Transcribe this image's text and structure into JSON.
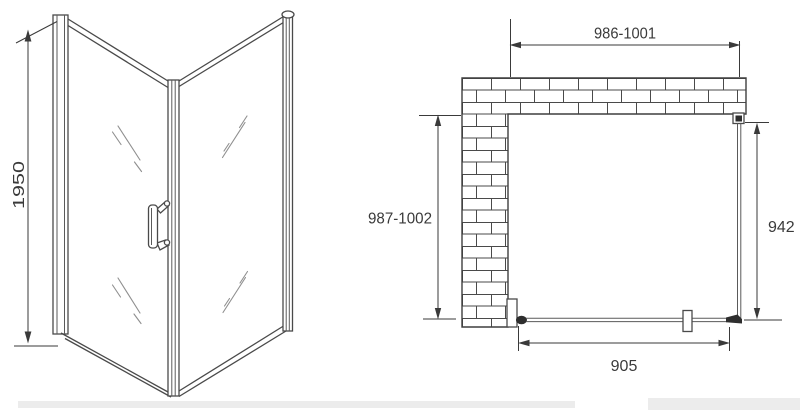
{
  "colors": {
    "background": "#ffffff",
    "line": "#4a4a4a",
    "dimension": "#3a3a3a",
    "dark_fill": "#2e2e2e",
    "glass_shine": "#8f8f8f",
    "brick": "#4a4a4a"
  },
  "iso_view": {
    "height_dimension": "1950"
  },
  "plan_view": {
    "opening_width_dimension": "986-1001",
    "depth_dimension": "987-1002",
    "side_panel_dimension": "942",
    "door_width_dimension": "905"
  }
}
